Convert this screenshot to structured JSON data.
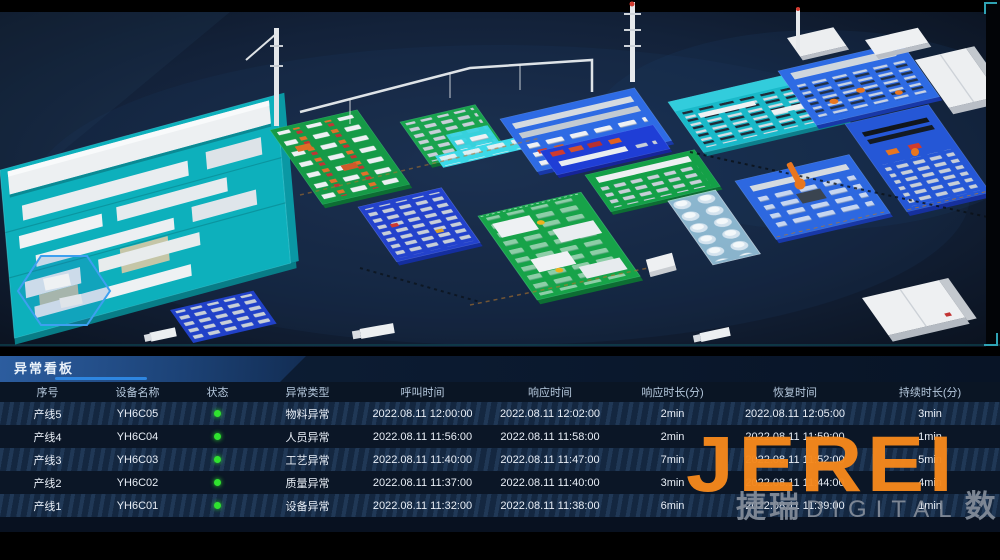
{
  "panel": {
    "title": "异常看板"
  },
  "watermark": {
    "brand": "JEREI",
    "sub_left": "捷瑞",
    "sub_mid": "DIGITAL",
    "sub_right": "数字"
  },
  "colors": {
    "accent_blue": "#2e86e0",
    "brand_orange": "#f5881c",
    "status_green": "#2fe32f"
  },
  "table": {
    "columns": [
      "序号",
      "设备名称",
      "状态",
      "异常类型",
      "呼叫时间",
      "响应时间",
      "响应时长(分)",
      "恢复时间",
      "持续时长(分)"
    ],
    "rows": [
      {
        "no": "产线5",
        "device": "YH6C05",
        "status": "green",
        "type": "物料异常",
        "call": "2022.08.11 12:00:00",
        "resp": "2022.08.11 12:02:00",
        "resp_min": "2min",
        "recover": "2022.08.11 12:05:00",
        "dur": "3min"
      },
      {
        "no": "产线4",
        "device": "YH6C04",
        "status": "green",
        "type": "人员异常",
        "call": "2022.08.11 11:56:00",
        "resp": "2022.08.11 11:58:00",
        "resp_min": "2min",
        "recover": "2022.08.11 11:59:00",
        "dur": "1min"
      },
      {
        "no": "产线3",
        "device": "YH6C03",
        "status": "green",
        "type": "工艺异常",
        "call": "2022.08.11 11:40:00",
        "resp": "2022.08.11 11:47:00",
        "resp_min": "7min",
        "recover": "2022.08.11 11:52:00",
        "dur": "5min"
      },
      {
        "no": "产线2",
        "device": "YH6C02",
        "status": "green",
        "type": "质量异常",
        "call": "2022.08.11 11:37:00",
        "resp": "2022.08.11 11:40:00",
        "resp_min": "3min",
        "recover": "2022.08.11 11:44:00",
        "dur": "4min"
      },
      {
        "no": "产线1",
        "device": "YH6C01",
        "status": "green",
        "type": "设备异常",
        "call": "2022.08.11 11:32:00",
        "resp": "2022.08.11 11:38:00",
        "resp_min": "6min",
        "recover": "2022.08.11 11:39:00",
        "dur": "1min"
      }
    ]
  }
}
